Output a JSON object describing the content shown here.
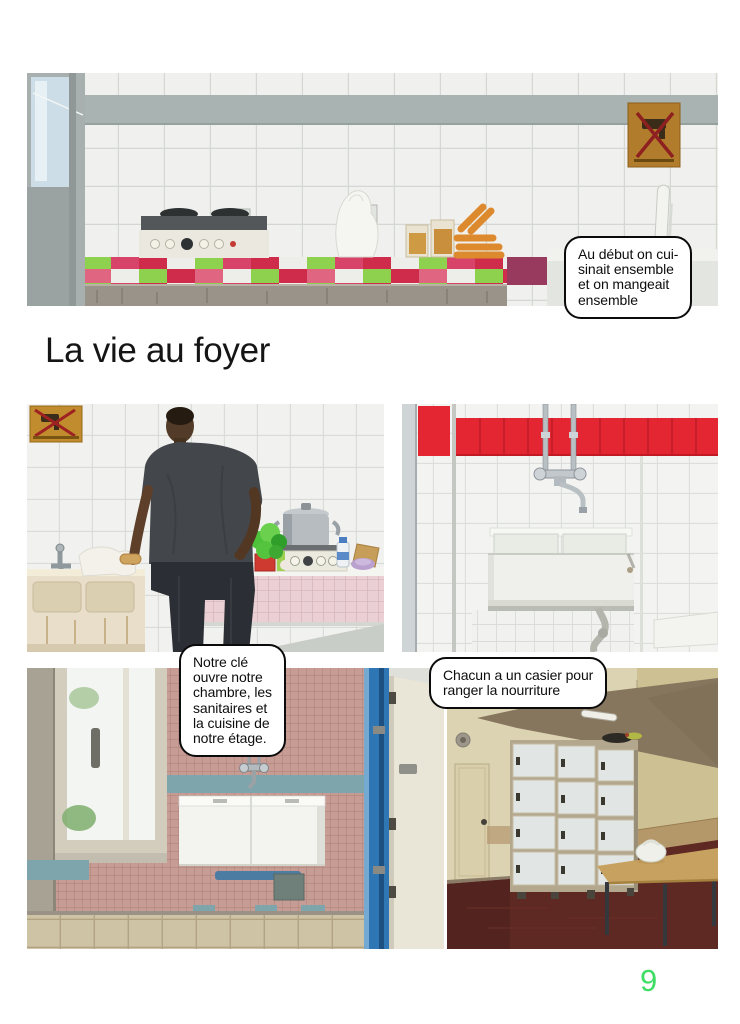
{
  "page": {
    "title": "La vie au foyer",
    "page_number": "9",
    "background": "#ffffff",
    "accent_green": "#3edd63"
  },
  "bubbles": {
    "cooking": {
      "lines": [
        "Au début on cui-",
        "sinait ensemble",
        "et on mangeait",
        "ensemble"
      ]
    },
    "key": {
      "lines": [
        "Notre clé",
        "ouvre notre",
        "chambre, les",
        "sanitaires et",
        "la cuisine de",
        "notre étage."
      ]
    },
    "locker": {
      "lines": [
        "Chacun a un casier pour",
        "ranger la nourriture"
      ]
    }
  },
  "photos": [
    {
      "id": "kitchen-counter",
      "label": "photo-shared-kitchen-hotplate-counter"
    },
    {
      "id": "man-cooking",
      "label": "photo-man-cooking-at-sink"
    },
    {
      "id": "red-tile-sink",
      "label": "photo-double-sink-red-tiles"
    },
    {
      "id": "washroom-sinks",
      "label": "photo-washroom-basins-window"
    },
    {
      "id": "food-lockers",
      "label": "photo-food-lockers-room"
    }
  ],
  "colors": {
    "red_tile": "#e42633",
    "pink_tile": "#c69c94",
    "blue_door": "#2e77b4",
    "maroon_floor": "#5e2823",
    "checker_green": "#8ed14e",
    "checker_red": "#cf2b4a"
  }
}
